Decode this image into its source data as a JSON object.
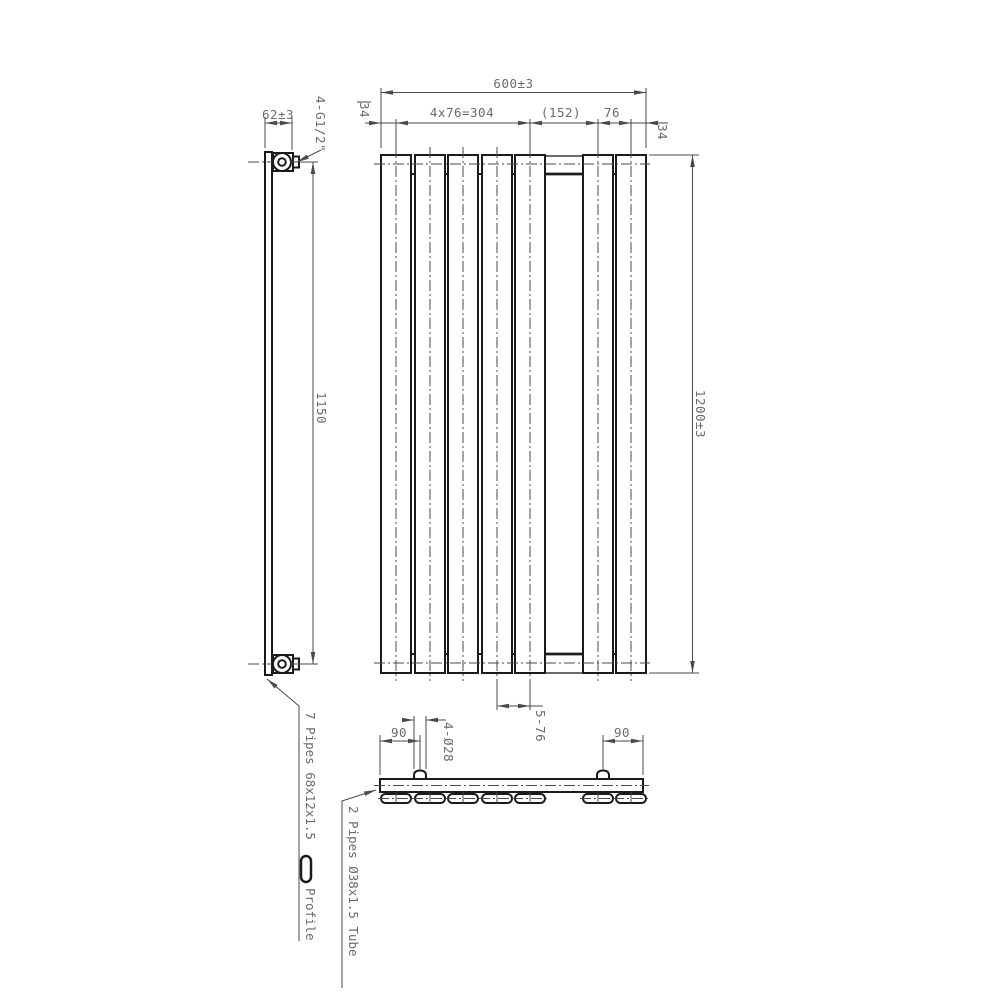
{
  "drawing": {
    "dims": {
      "overall_width": "600±3",
      "margin_left": "34",
      "pitch_group": "4x76=304",
      "center_gap": "(152)",
      "pitch_right": "76",
      "margin_right": "34",
      "overall_height": "1200±3",
      "depth": "62±3",
      "connections": "4-G1/2\"",
      "pipe_centres": "1150",
      "panel_pitch": "5-76",
      "inlet_left": "90",
      "inlet_right": "90",
      "boss_diameter": "4-Ø28"
    },
    "notes": {
      "profile_prefix": "7  Pipes  68x12x1.5",
      "profile_suffix": "Profile",
      "tube": "2  Pipes  Ø38x1.5  Tube"
    },
    "colors": {
      "object_line": "#1b1b1b",
      "dim_line": "#4a4a4a",
      "dim_text": "#6a6a6a",
      "background": "#ffffff"
    }
  }
}
